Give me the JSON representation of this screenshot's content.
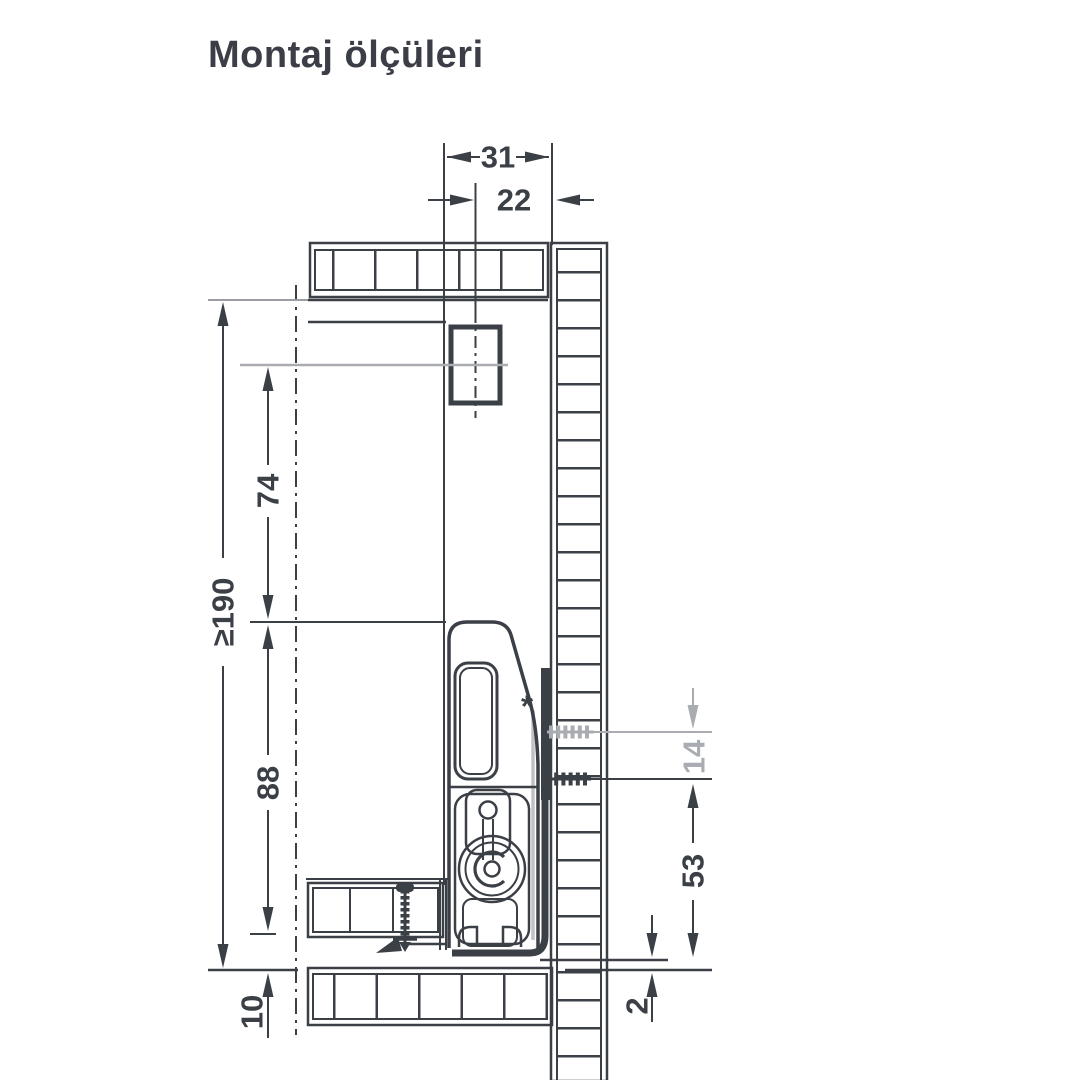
{
  "page": {
    "title": "Montaj ölçüleri"
  },
  "colors": {
    "ink": "#3b3f46",
    "muted": "#a9adb1",
    "background": "#ffffff"
  },
  "dimensions": {
    "bracket_offset": {
      "label": "31"
    },
    "bracket_center_offset": {
      "label": "22"
    },
    "min_inner_height": {
      "label": "≥190"
    },
    "upper_hole_spacing": {
      "label": "74"
    },
    "lower_hole_spacing": {
      "label": "88"
    },
    "front_bottom_overlap": {
      "label": "10"
    },
    "rear_screw_offset": {
      "label": "14"
    },
    "bottom_hole_height": {
      "label": "53"
    },
    "bottom_clearance": {
      "label": "2"
    }
  },
  "annotations": {
    "asterisk": "*"
  }
}
